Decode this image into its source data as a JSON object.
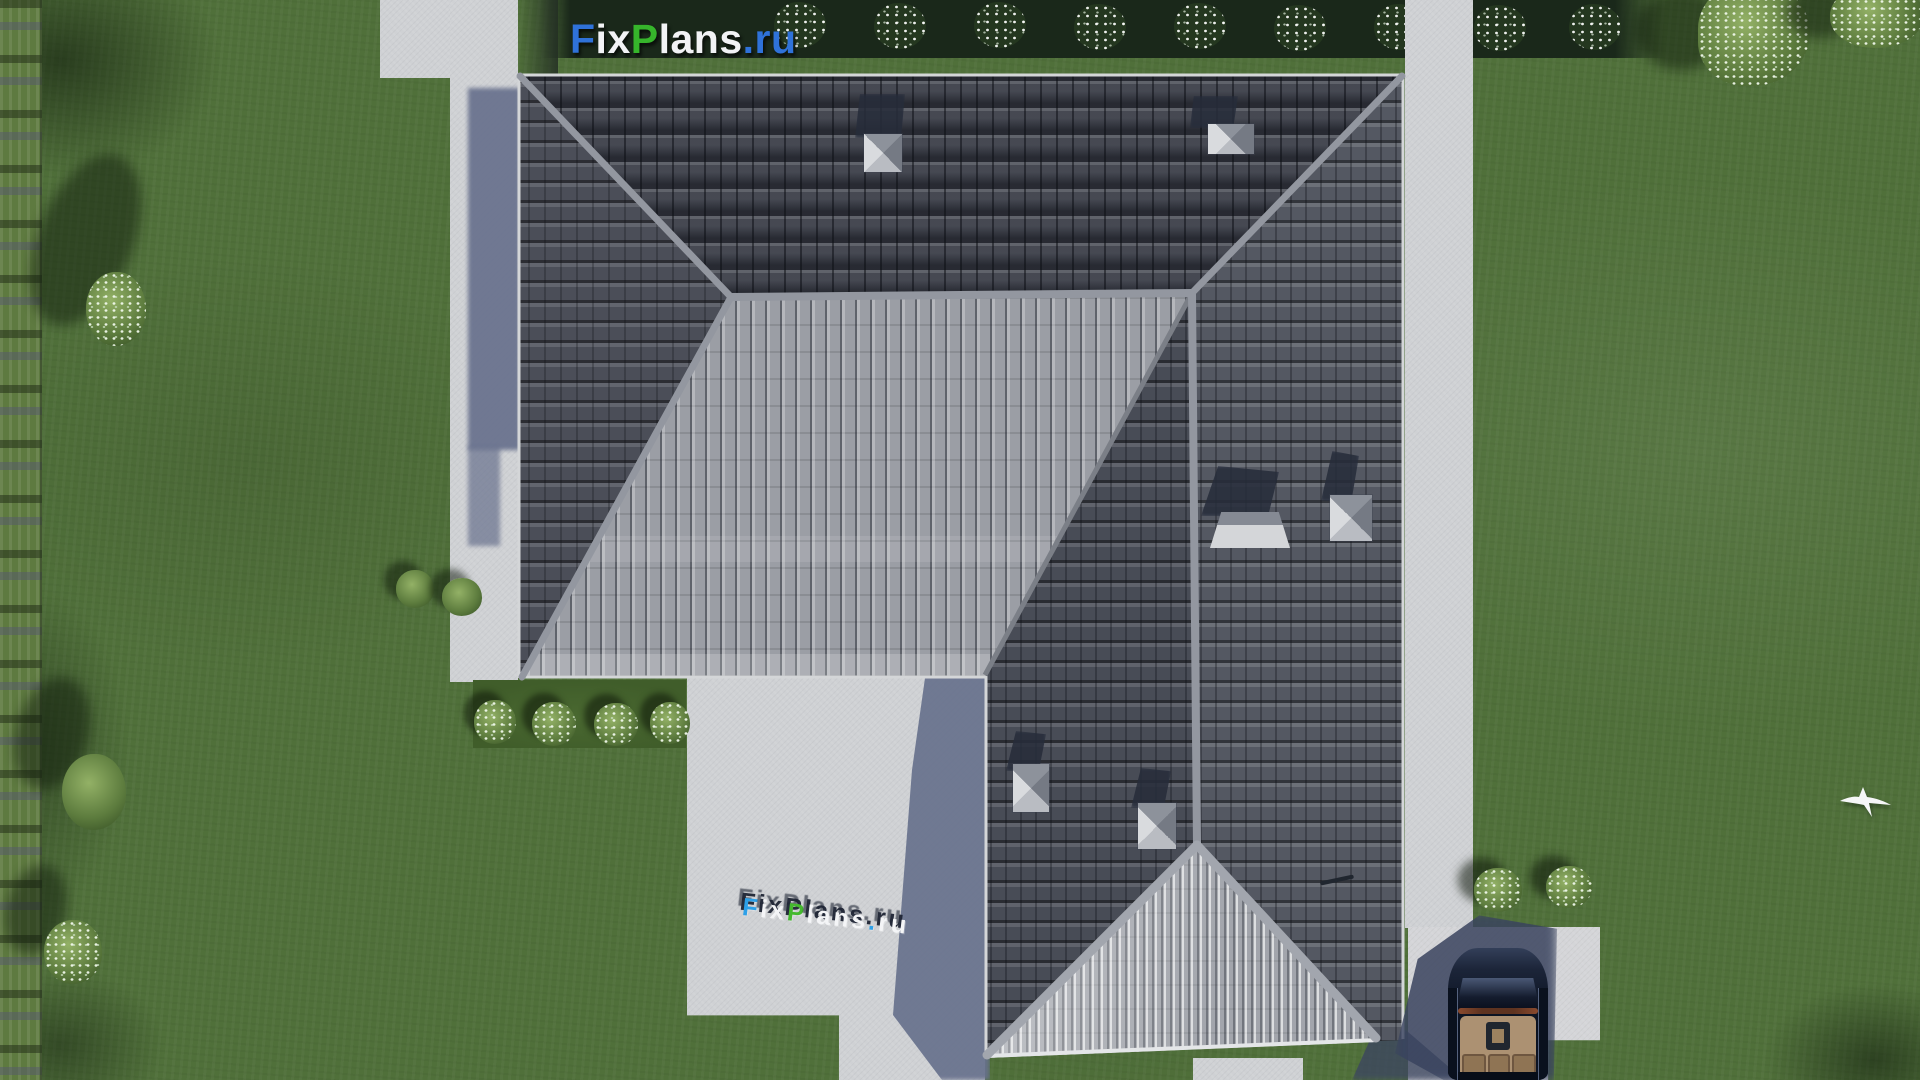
{
  "watermark_logo": {
    "text": "FixPlans.ru",
    "parts": [
      {
        "text": "F",
        "color": "#2f72d9"
      },
      {
        "text": "ix",
        "color": "#f2f3f5"
      },
      {
        "text": "P",
        "color": "#36b52b"
      },
      {
        "text": "lans",
        "color": "#f2f3f5"
      },
      {
        "text": ".ru",
        "color": "#2f72d9"
      }
    ]
  },
  "ground_sign": {
    "text": "FixPlans.ru",
    "letters": [
      {
        "char": "F",
        "color": "#2da0e8"
      },
      {
        "char": "i",
        "color": "#f4f5f7"
      },
      {
        "char": "x",
        "color": "#f4f5f7"
      },
      {
        "char": "P",
        "color": "#45b92f"
      },
      {
        "char": "l",
        "color": "#f4f5f7"
      },
      {
        "char": "a",
        "color": "#f4f5f7"
      },
      {
        "char": "n",
        "color": "#f4f5f7"
      },
      {
        "char": "s",
        "color": "#f4f5f7"
      },
      {
        "char": ".",
        "color": "#2da0e8"
      },
      {
        "char": "r",
        "color": "#f4f5f7"
      },
      {
        "char": "u",
        "color": "#f4f5f7"
      }
    ]
  },
  "scene": {
    "type": "aerial-3d-render",
    "subject": "top-down view of a single-family house with gray hipped tile roof, lawn, paths, patio, driveway with convertible car, hedges, shrubs, trees and a flying bird",
    "objects": [
      "house-roof",
      "chimney-caps",
      "lawn",
      "left-hedge",
      "top-hedge-with-bushes",
      "garden-paths",
      "patio",
      "driveway",
      "convertible-car",
      "flying-bird",
      "shrubs",
      "trees",
      "flower-bed"
    ]
  },
  "palette": {
    "lawn": "#50703a",
    "hedge_dark": "#1a281a",
    "roof_dark": "#42454f",
    "roof_medium": "#545862",
    "roof_light": "#9b9ea5",
    "roof_gable": "#b2b5bb",
    "ridge_cap": "#9397a0",
    "concrete": "#cfd1d4",
    "cast_shadow": "#68718d",
    "car_body": "#0e1626",
    "car_interior": "#ac9172",
    "accent_blue": "#2f72d9",
    "accent_green": "#36b52b"
  }
}
